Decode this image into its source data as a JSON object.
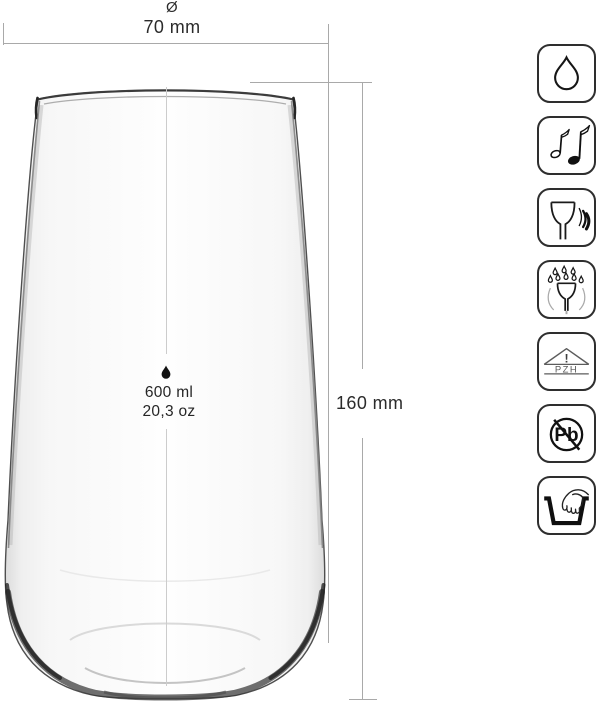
{
  "dimensions": {
    "diameter_symbol": "Ø",
    "diameter": "70 mm",
    "height": "160 mm"
  },
  "capacity": {
    "volume_ml": "600 ml",
    "volume_oz": "20,3 oz"
  },
  "feature_icons": [
    {
      "name": "water-drop"
    },
    {
      "name": "music-notes"
    },
    {
      "name": "glass-resonance"
    },
    {
      "name": "dishwasher-safe"
    },
    {
      "name": "pzh-certificate",
      "exclamation": "!",
      "label": "PZH"
    },
    {
      "name": "lead-free",
      "label": "Pb"
    },
    {
      "name": "hand-wash"
    }
  ],
  "colors": {
    "background": "#ffffff",
    "dimension_line": "#a9a9a9",
    "center_line": "#cccccc",
    "text": "#2b2b2b",
    "icon_border": "#2e2e2e",
    "icon_ink": "#141414"
  }
}
